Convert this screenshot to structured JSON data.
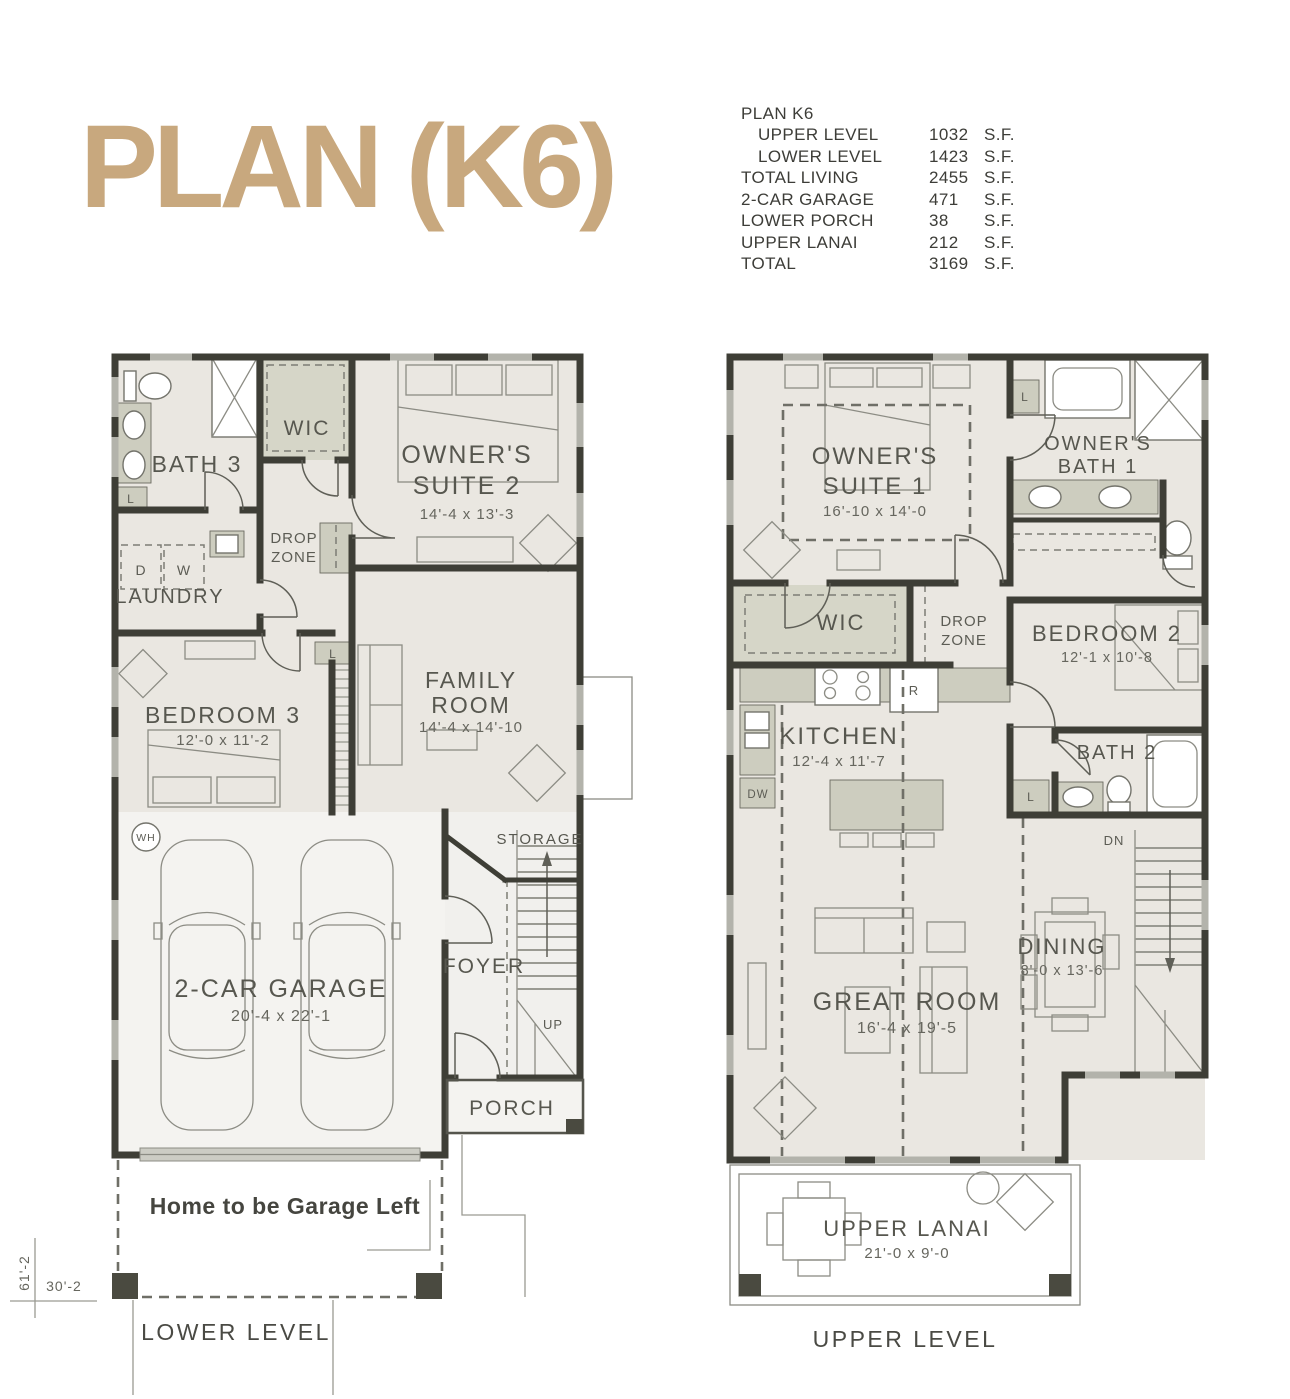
{
  "title": {
    "text": "PLAN (K6)",
    "color": "#C8A87E"
  },
  "stats": {
    "heading": "PLAN K6",
    "rows": [
      {
        "label": "UPPER LEVEL",
        "value": "1032",
        "unit": "S.F."
      },
      {
        "label": "LOWER LEVEL",
        "value": "1423",
        "unit": "S.F."
      },
      {
        "label": "TOTAL LIVING",
        "value": "2455",
        "unit": "S.F."
      },
      {
        "label": "2-CAR GARAGE",
        "value": "471",
        "unit": "S.F."
      },
      {
        "label": "LOWER PORCH",
        "value": "38",
        "unit": "S.F."
      },
      {
        "label": "UPPER LANAI",
        "value": "212",
        "unit": "S.F."
      },
      {
        "label": "TOTAL",
        "value": "3169",
        "unit": "S.F."
      }
    ]
  },
  "lower": {
    "caption": "LOWER LEVEL",
    "note": "Home to be Garage Left",
    "width_dim": "30'-2",
    "height_dim": "61'-2",
    "rooms": {
      "bath3": "BATH 3",
      "wic": "WIC",
      "owners_suite2_1": "OWNER'S",
      "owners_suite2_2": "SUITE 2",
      "owners_suite2_dims": "14'-4 x 13'-3",
      "drop_zone_1": "DROP",
      "drop_zone_2": "ZONE",
      "laundry": "LAUNDRY",
      "dryer": "D",
      "washer": "W",
      "bedroom3": "BEDROOM 3",
      "bedroom3_dims": "12'-0 x 11'-2",
      "family_1": "FAMILY",
      "family_2": "ROOM",
      "family_dims": "14'-4 x 14'-10",
      "linen_bath": "L",
      "linen_hall": "L",
      "water_heater": "WH",
      "storage": "STORAGE",
      "garage": "2-CAR GARAGE",
      "garage_dims": "20'-4 x 22'-1",
      "foyer": "FOYER",
      "up": "UP",
      "porch": "PORCH"
    }
  },
  "upper": {
    "caption": "UPPER LEVEL",
    "rooms": {
      "owners_suite1_1": "OWNER'S",
      "owners_suite1_2": "SUITE 1",
      "owners_suite1_dims": "16'-10 x 14'-0",
      "owners_bath1_1": "OWNER'S",
      "owners_bath1_2": "BATH 1",
      "linen1": "L",
      "wic": "WIC",
      "drop_zone_1": "DROP",
      "drop_zone_2": "ZONE",
      "bedroom2": "BEDROOM 2",
      "bedroom2_dims": "12'-1 x 10'-8",
      "kitchen": "KITCHEN",
      "kitchen_dims": "12'-4 x 11'-7",
      "fridge": "R",
      "dishwasher": "DW",
      "bath2": "BATH 2",
      "linen2": "L",
      "dn": "DN",
      "great_room": "GREAT ROOM",
      "great_room_dims": "16'-4 x 19'-5",
      "dining": "DINING",
      "dining_dims": "8'-0 x 13'-6",
      "upper_lanai": "UPPER LANAI",
      "upper_lanai_dims": "21'-0 x 9'-0"
    }
  }
}
